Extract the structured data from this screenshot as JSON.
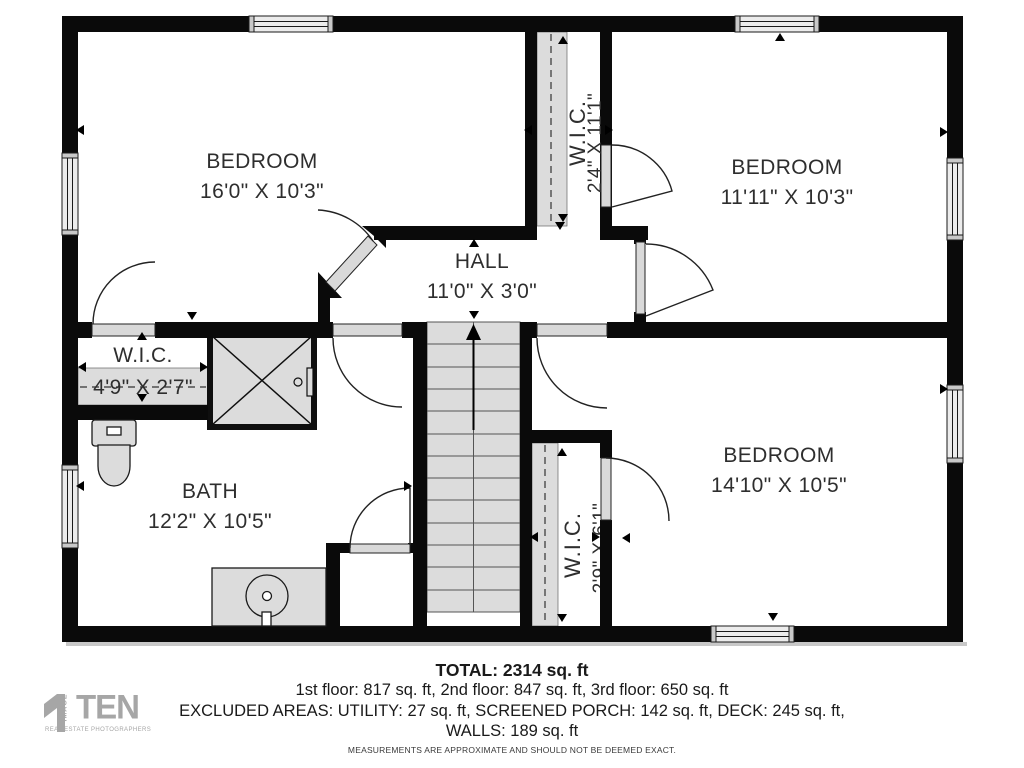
{
  "rooms": [
    {
      "id": "bedroom-1",
      "name": "BEDROOM",
      "dims": "16'0\" X 10'3\""
    },
    {
      "id": "bedroom-2",
      "name": "BEDROOM",
      "dims": "11'11\" X 10'3\""
    },
    {
      "id": "hall",
      "name": "HALL",
      "dims": "11'0\" X 3'0\""
    },
    {
      "id": "wic-top",
      "name": "W.I.C.",
      "dims": "2'4\" X 11'1\""
    },
    {
      "id": "wic-left",
      "name": "W.I.C.",
      "dims": "4'9\" X 2'7\""
    },
    {
      "id": "bath",
      "name": "BATH",
      "dims": "12'2\" X 10'5\""
    },
    {
      "id": "wic-bottom",
      "name": "W.I.C.",
      "dims": "2'9\" X 6'1\""
    },
    {
      "id": "bedroom-3",
      "name": "BEDROOM",
      "dims": "14'10\" X 10'5\""
    }
  ],
  "footer": {
    "total": "TOTAL: 2314 sq. ft",
    "floors": "1st floor: 817 sq. ft, 2nd floor: 847 sq. ft, 3rd floor: 650 sq. ft",
    "excluded": "EXCLUDED AREAS: UTILITY: 27 sq. ft, SCREENED PORCH: 142 sq. ft, DECK: 245 sq. ft,",
    "walls": "WALLS: 189 sq. ft",
    "disclaimer": "MEASUREMENTS ARE APPROXIMATE AND SHOULD NOT BE DEEMED EXACT."
  },
  "logo": {
    "brand": "TEN",
    "vertical": "IMAGE",
    "tagline": "REAL ESTATE PHOTOGRAPHERS"
  },
  "colors": {
    "wall": "#0a0a0a",
    "fixture_fill": "#dcdcdc",
    "label_text": "#2e2e2e",
    "logo_gray": "#a6a6a6"
  }
}
